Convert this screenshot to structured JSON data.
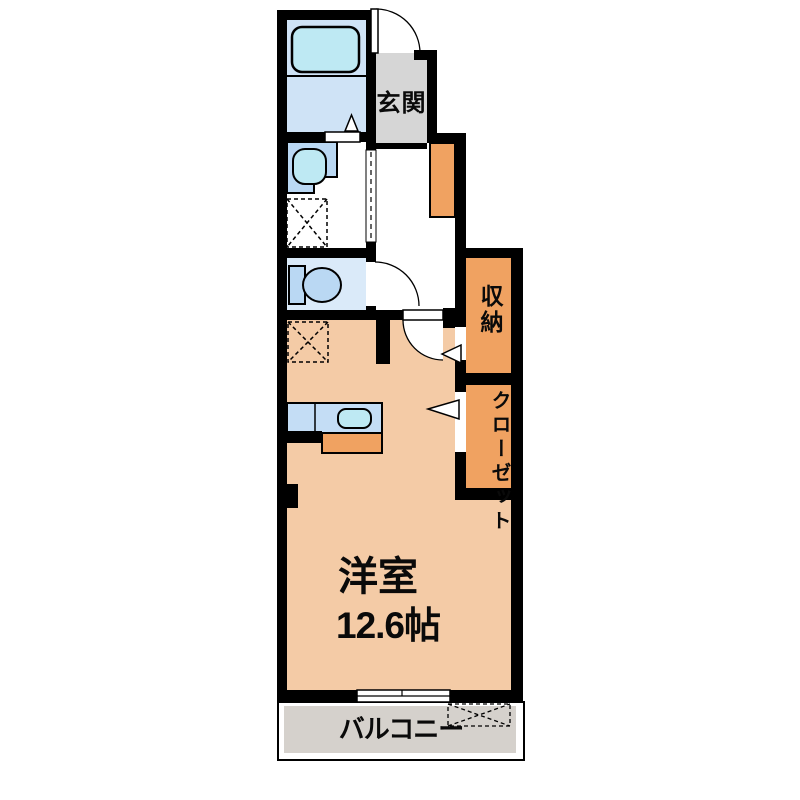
{
  "plan": {
    "type": "apartment-floor-plan",
    "labels": {
      "entrance": "玄関",
      "storage": "収納",
      "closet": "クローゼット",
      "room_name": "洋室",
      "room_size": "12.6帖",
      "balcony": "バルコニー"
    },
    "fixtures": [
      "bathtub",
      "washbasin",
      "toilet",
      "washing-machine-space",
      "refrigerator-space",
      "kitchen-counter",
      "kitchen-sink",
      "shoe-cabinet",
      "entrance-door",
      "toilet-door",
      "room-door",
      "sliding-door",
      "balcony-window"
    ]
  },
  "colors": {
    "background": "#FFFFFF",
    "wall": "#000000",
    "room_floor": "#F4CBA6",
    "storage_fill": "#F0A261",
    "entrance_floor": "#D6D6D6",
    "balcony_floor": "#D5D1CC",
    "bath_floor": "#CFE3F6",
    "toilet_floor": "#DAEAF9",
    "fixture_blue": "#BAD8F3",
    "fixture_cyan": "#BEE9F3",
    "counter_blue": "#C4DDF5"
  }
}
